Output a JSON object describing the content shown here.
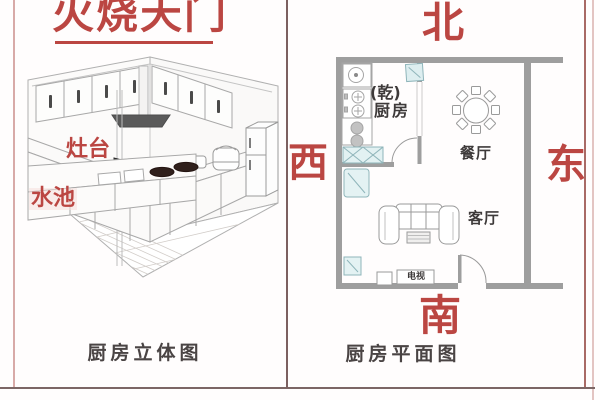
{
  "title": {
    "text": "火烧天门"
  },
  "left_panel": {
    "caption": "厨房立体图",
    "stove_label": "灶台",
    "sink_label": "水池"
  },
  "right_panel": {
    "caption": "厨房平面图",
    "compass": {
      "north": "北",
      "west": "西",
      "east": "东",
      "south": "南"
    },
    "rooms": {
      "trigram": "(乾)",
      "kitchen": "厨房",
      "dining": "餐厅",
      "living": "客厅",
      "tv": "电视"
    }
  },
  "colors": {
    "accent_red": "#bb4642",
    "wall_gray": "#9e9e9e",
    "line_gray": "#a8a8a8",
    "teal_fill": "#e2f1f2",
    "teal_stroke": "#8fb5ba",
    "label_dark": "#3e3a3a",
    "caption_gray": "#4a4444",
    "border_pink": "#d8aaa8",
    "border_dark": "#7c6060"
  }
}
